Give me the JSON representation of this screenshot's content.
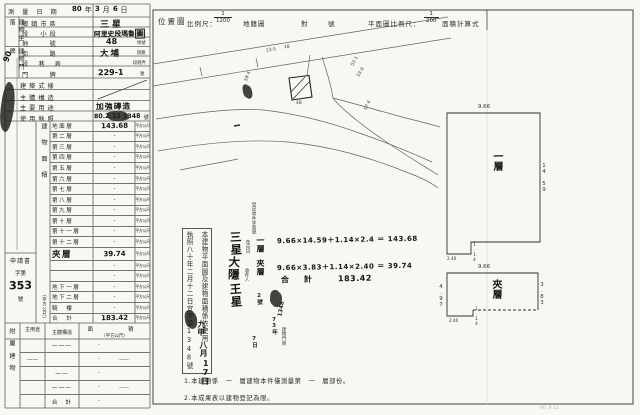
{
  "upper": {
    "survey_date": {
      "label": "測量日期",
      "parts": [
        {
          "t": "80",
          "cls": "hw"
        },
        {
          "t": "年",
          "cls": "pr"
        },
        {
          "t": "3",
          "cls": "hw"
        },
        {
          "t": "月",
          "cls": "pr"
        },
        {
          "t": "6",
          "cls": "hw"
        },
        {
          "t": "日",
          "cls": "pr"
        }
      ]
    },
    "group_location": "建物坐落",
    "group_address": "建物門牌",
    "township": {
      "label": "鄉鎮市區",
      "value": "三星"
    },
    "section": {
      "label": "段　小段",
      "value": "阿里史段瑪魯",
      "boxed": "圍",
      "unit": "小段"
    },
    "lot": {
      "label": "地　　號",
      "value": "48",
      "unit": "地號"
    },
    "street": {
      "label": "街　　路",
      "value": "大埔",
      "unit": "街路"
    },
    "lane": {
      "label": "段　巷　弄",
      "value": "",
      "unit": "段巷弄"
    },
    "door": {
      "label": "門　　牌",
      "value": "229-1",
      "unit": "號"
    },
    "style": {
      "label": "建築式樣",
      "value": ""
    },
    "structure": {
      "label": "主體構造",
      "value": ""
    },
    "use": {
      "label": "主要用途",
      "value": "加強磚造"
    },
    "license": {
      "label": "使用執照",
      "date": "80.2.12",
      "no": "1348",
      "unit": "號"
    }
  },
  "floors_group": {
    "title": "建物面積",
    "unit": "（平方公尺）"
  },
  "floors": [
    {
      "label": "地面層",
      "value": "143.68",
      "value_cls": "hw",
      "unit": "平方公尺"
    },
    {
      "label": "第二層",
      "value": "·",
      "unit": "平方公尺"
    },
    {
      "label": "第三層",
      "value": "·",
      "unit": "平方公尺"
    },
    {
      "label": "第四層",
      "value": "·",
      "unit": "平方公尺"
    },
    {
      "label": "第五層",
      "value": "·",
      "unit": "平方公尺"
    },
    {
      "label": "第六層",
      "value": "·",
      "unit": "平方公尺"
    },
    {
      "label": "第七層",
      "value": "·",
      "unit": "平方公尺"
    },
    {
      "label": "第八層",
      "value": "·",
      "unit": "平方公尺"
    },
    {
      "label": "第九層",
      "value": "·",
      "unit": "平方公尺"
    },
    {
      "label": "第十層",
      "value": "·",
      "unit": "平方公尺"
    },
    {
      "label": "第十一層",
      "value": "·",
      "unit": "平方公尺"
    },
    {
      "label": "第十二層",
      "value": "·",
      "unit": "平方公尺"
    },
    {
      "label": "夾層",
      "label_cls": "hw-big",
      "value": "39.74",
      "value_cls": "hw",
      "unit": "平方公尺"
    },
    {
      "label": "",
      "value": "·",
      "unit": "平方公尺"
    },
    {
      "label": "",
      "value": "·",
      "unit": "平方公尺"
    },
    {
      "label": "地下一層",
      "value": "·",
      "unit": "平方公尺"
    },
    {
      "label": "地下二層",
      "value": "·",
      "unit": "平方公尺"
    },
    {
      "label": "騎　樓",
      "value": "·",
      "unit": "平方公尺"
    },
    {
      "label": "合　計",
      "value": "183.42",
      "value_cls": "hw",
      "unit": "平方公尺"
    }
  ],
  "filing": {
    "title": "申請書",
    "prefix": "字第",
    "number": "353",
    "suffix": "號"
  },
  "annex": {
    "group": "附屬建物",
    "headers": {
      "use": "主用途",
      "structure": "主體構造",
      "area": "面　　積",
      "area_unit": "（平方公尺）"
    },
    "rows": [
      {
        "c1": "",
        "c2": "———",
        "v": "·",
        "v2": ""
      },
      {
        "c1": "——",
        "c2": "",
        "v": "·",
        "v2": "——"
      },
      {
        "c1": "",
        "c2": "——",
        "v": "·",
        "v2": ""
      },
      {
        "c1": "",
        "c2": "———",
        "v": "·",
        "v2": "——"
      },
      {
        "c1": "",
        "c2": "合　計",
        "v": "·",
        "v2": ""
      }
    ]
  },
  "header": {
    "location_map": "位置圖",
    "scale_label": "比例尺：",
    "scale_num": "1",
    "scale_den": "1200",
    "cadastral": "地籍圖",
    "duei": "對",
    "hao": "號",
    "plan_scale_label": "平面圖比例尺：",
    "plan_num": "1",
    "plan_den": "200",
    "area_calc": "面積計算式"
  },
  "map_labels": [
    {
      "t": "13-5",
      "x": 266,
      "y": 48,
      "r": -8
    },
    {
      "t": "18",
      "x": 284,
      "y": 45,
      "r": -8
    },
    {
      "t": "58-4",
      "x": 243,
      "y": 74,
      "r": -70
    },
    {
      "t": "53-1",
      "x": 350,
      "y": 59,
      "r": -60
    },
    {
      "t": "53-9",
      "x": 356,
      "y": 70,
      "r": -60
    },
    {
      "t": "57-6",
      "x": 363,
      "y": 103,
      "r": -65
    },
    {
      "t": "48",
      "x": 296,
      "y": 101,
      "r": 0
    }
  ],
  "calc": {
    "row1_label": "一層",
    "row1": "9.66×14.59＋1.14×2.4 ＝ 143.68",
    "row2_label": "夾層",
    "row2": "9.66×3.83＋1.14×2.40 ＝ 39.74",
    "total_label": "合 計",
    "total": "183.42"
  },
  "note_box": {
    "line_right": "本建物平面圖及建物面積係依使用",
    "line_left": "執照八十年二月十二日宜字第1348號"
  },
  "scrawls": [
    {
      "t": "90",
      "x": 2,
      "y": 52,
      "cls": "sc-med",
      "r": -70
    },
    {
      "t": "登記收件字第號",
      "x": 250,
      "y": 202,
      "cls": "sc-tiny",
      "vert": true
    },
    {
      "t": "年月日",
      "x": 244,
      "y": 240,
      "cls": "sc-tiny",
      "vert": true
    },
    {
      "t": "三星",
      "x": 228,
      "y": 231,
      "cls": "sc-big",
      "vert": true,
      "r": -3
    },
    {
      "t": "大隱",
      "x": 226,
      "y": 256,
      "cls": "sc-big",
      "vert": true,
      "r": 2
    },
    {
      "t": "收件人",
      "x": 243,
      "y": 268,
      "cls": "sc-tiny",
      "vert": true
    },
    {
      "t": "王星",
      "x": 228,
      "y": 283,
      "cls": "sc-big",
      "vert": true,
      "r": -4
    },
    {
      "t": "2號",
      "x": 255,
      "y": 293,
      "cls": "sc-sm",
      "vert": true
    },
    {
      "t": "1348",
      "x": 274,
      "y": 306,
      "cls": "sc-sm",
      "r": -80
    },
    {
      "t": "73年",
      "x": 270,
      "y": 317,
      "cls": "sc-sm",
      "vert": true
    },
    {
      "t": "九甲",
      "x": 196,
      "y": 320,
      "cls": "sc-med",
      "vert": true,
      "r": 3
    },
    {
      "t": "八月",
      "x": 198,
      "y": 341,
      "cls": "sc-med",
      "vert": true,
      "r": -2
    },
    {
      "t": "17日",
      "x": 200,
      "y": 359,
      "cls": "sc-med",
      "vert": true,
      "r": 2
    },
    {
      "t": "7日",
      "x": 250,
      "y": 336,
      "cls": "sc-sm",
      "vert": true
    },
    {
      "t": "建物門牌",
      "x": 280,
      "y": 327,
      "cls": "sc-tiny",
      "vert": true
    }
  ],
  "blobs": [
    {
      "x": 1,
      "y": 83,
      "w": 13,
      "h": 48,
      "r": 8
    },
    {
      "x": 243,
      "y": 85,
      "w": 9,
      "h": 13,
      "r": -10
    },
    {
      "x": 270,
      "y": 291,
      "w": 12,
      "h": 15,
      "r": 5
    },
    {
      "x": 185,
      "y": 311,
      "w": 12,
      "h": 17,
      "r": -6
    },
    {
      "x": 107,
      "y": 112,
      "w": 22,
      "h": 8,
      "r": -2
    }
  ],
  "plans": {
    "floor1": {
      "name": "一層",
      "dim_top": "9.66",
      "dim_right": "14.59",
      "dim_tab_h": "1.14",
      "dim_tab_w": "2.40"
    },
    "mezzanine": {
      "name": "夾層",
      "dim_top": "9.66",
      "dim_right": "3.83",
      "dim_left": "4.97",
      "dim_tab_h": "1.14",
      "dim_tab_w": "2.40"
    }
  },
  "notes": {
    "n1": "1.本建物係　一　層建物本件僅測量第　一　層部份。",
    "n2": "2.本成果表以建物登記為限。"
  },
  "footer_faint": "90. 8.12"
}
